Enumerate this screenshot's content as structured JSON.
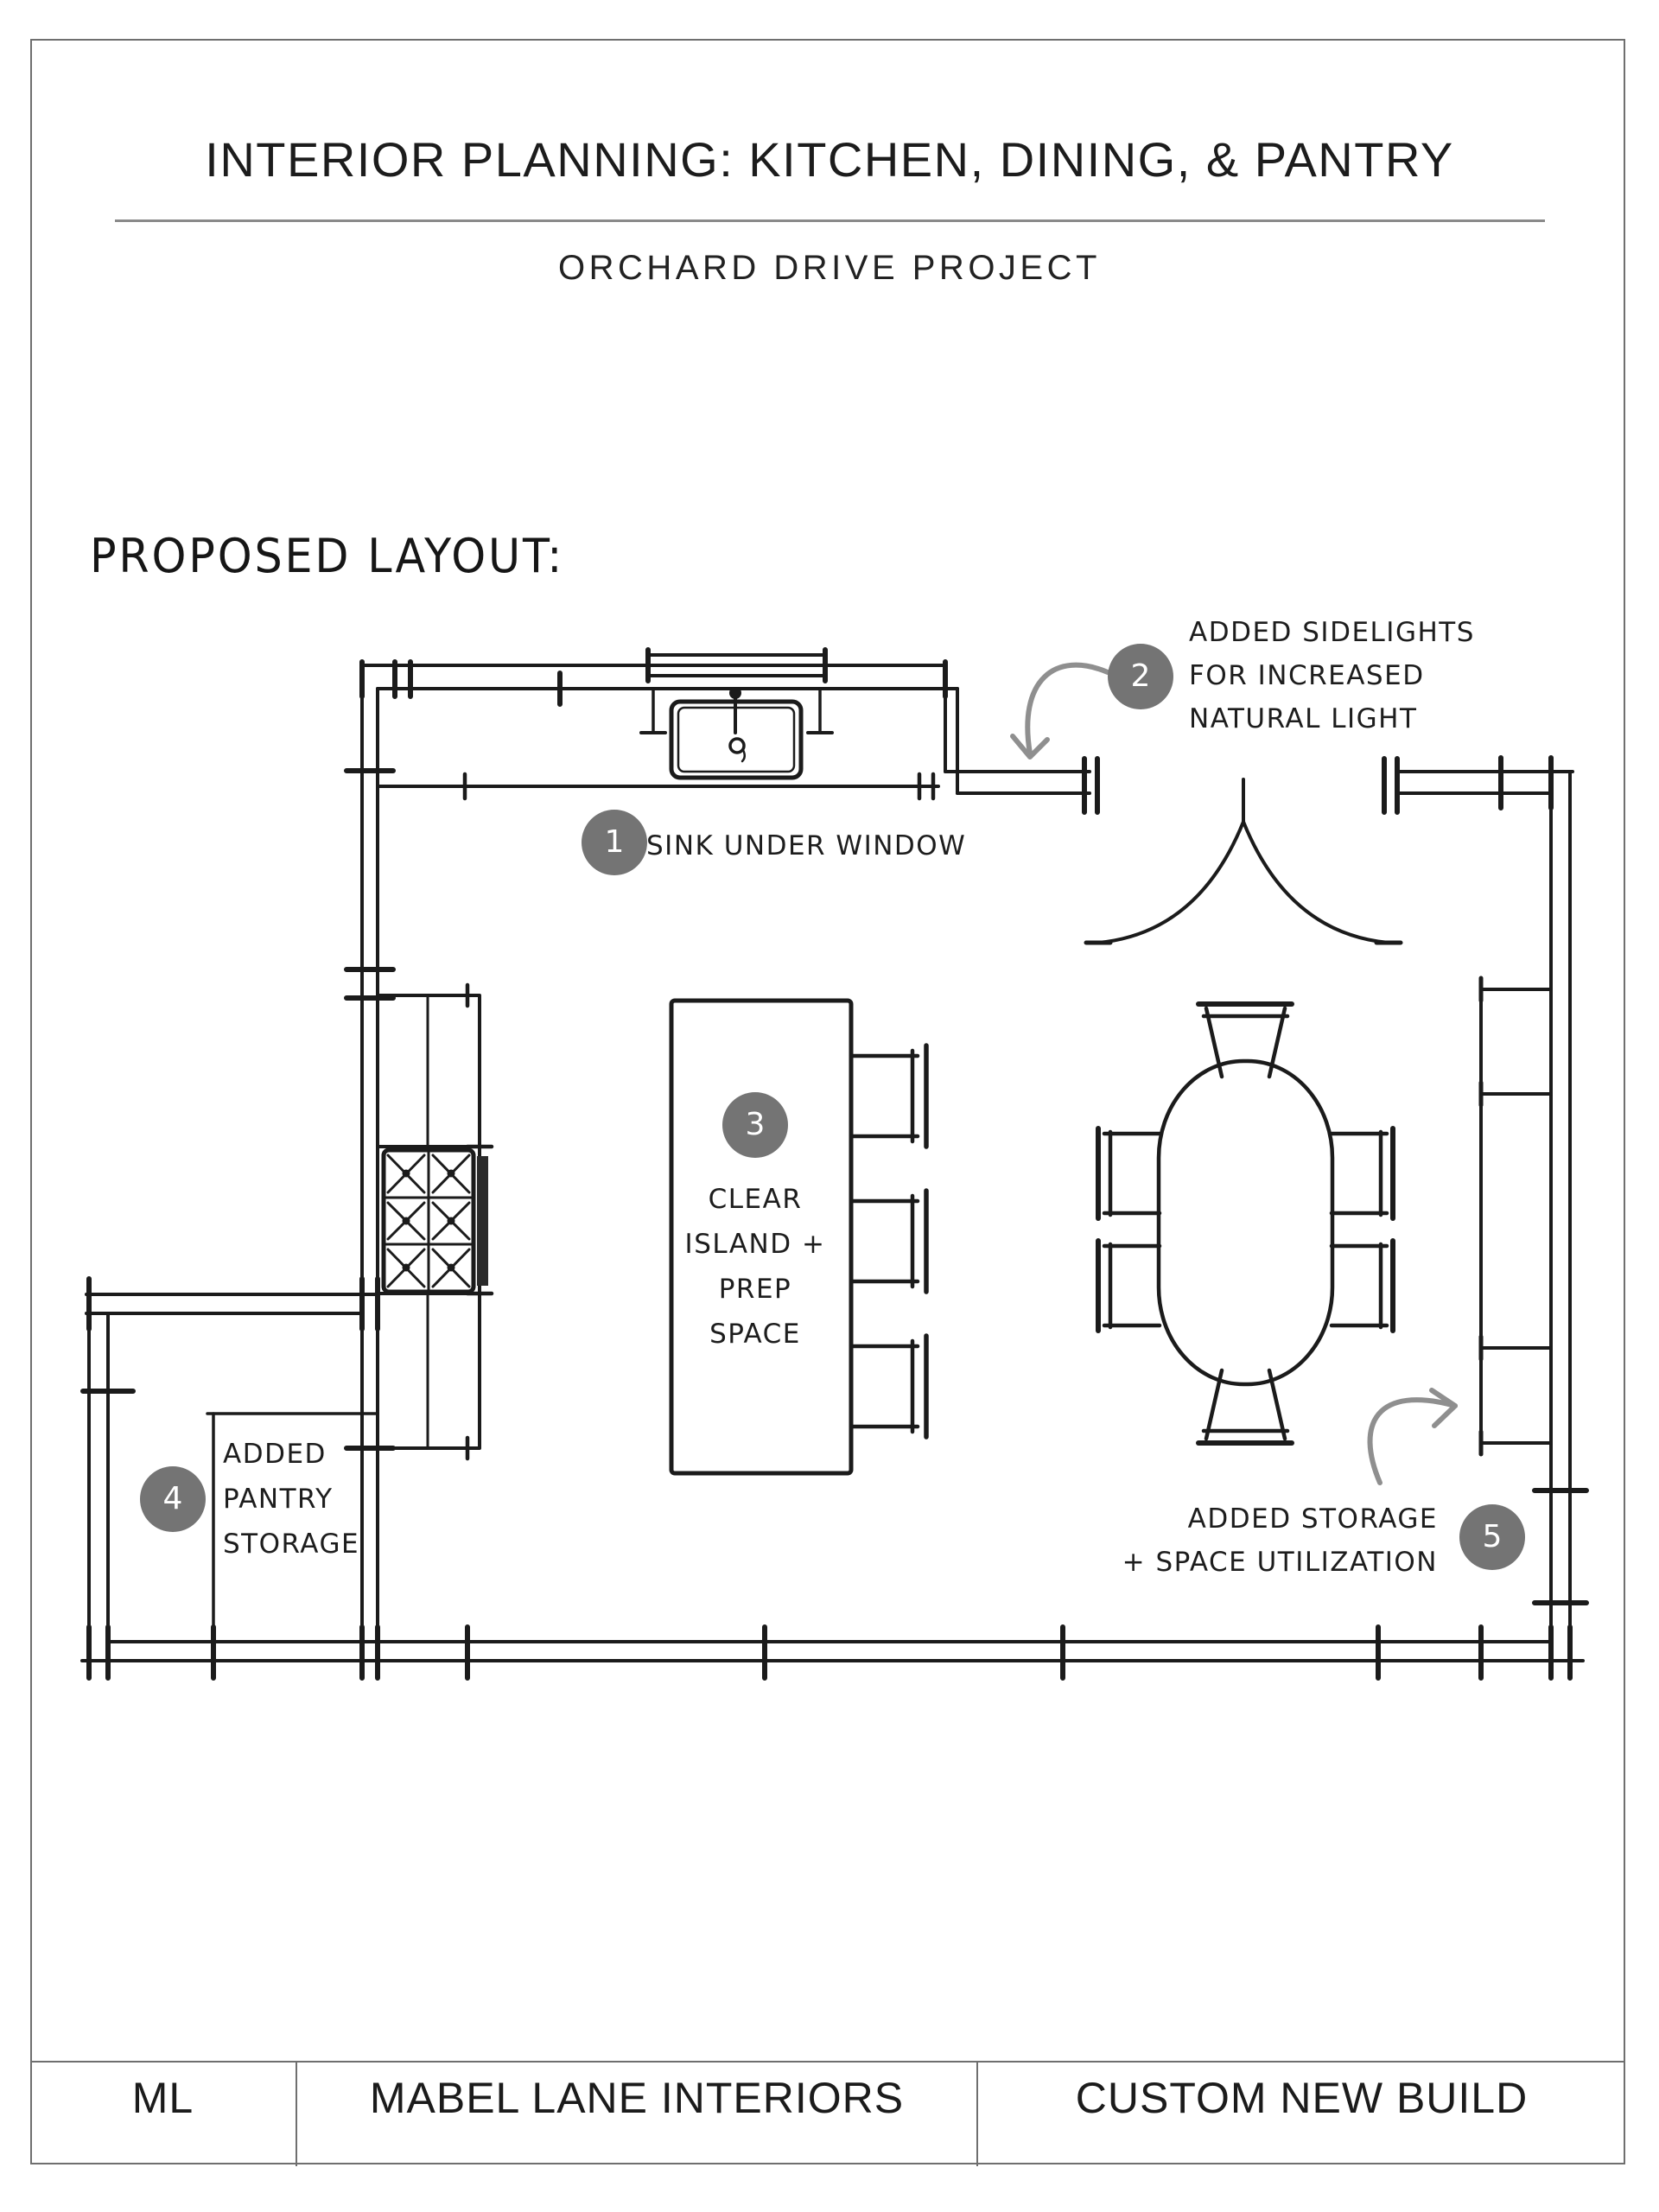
{
  "page": {
    "title": "INTERIOR PLANNING: KITCHEN, DINING, & PANTRY",
    "subtitle": "ORCHARD DRIVE PROJECT",
    "section_heading": "PROPOSED LAYOUT:"
  },
  "annotations": {
    "a1": {
      "number": "1",
      "lines": [
        "SINK UNDER WINDOW"
      ]
    },
    "a2": {
      "number": "2",
      "lines": [
        "ADDED SIDELIGHTS",
        "FOR INCREASED",
        "NATURAL LIGHT"
      ]
    },
    "a3": {
      "number": "3",
      "lines": [
        "CLEAR",
        "ISLAND +",
        "PREP",
        "SPACE"
      ]
    },
    "a4": {
      "number": "4",
      "lines": [
        "ADDED",
        "PANTRY",
        "STORAGE"
      ]
    },
    "a5": {
      "number": "5",
      "lines": [
        "ADDED STORAGE",
        "+ SPACE UTILIZATION"
      ]
    }
  },
  "footer": {
    "logo": "ML",
    "company": "MABEL LANE INTERIORS",
    "project": "CUSTOM NEW BUILD"
  },
  "colors": {
    "ink": "#1b1b1b",
    "badge_fill": "#747474",
    "badge_number": "#ffffff",
    "annotation_gray": "#8f8f8f",
    "page_border": "#6f6f6f",
    "divider": "#8a8a8a"
  }
}
